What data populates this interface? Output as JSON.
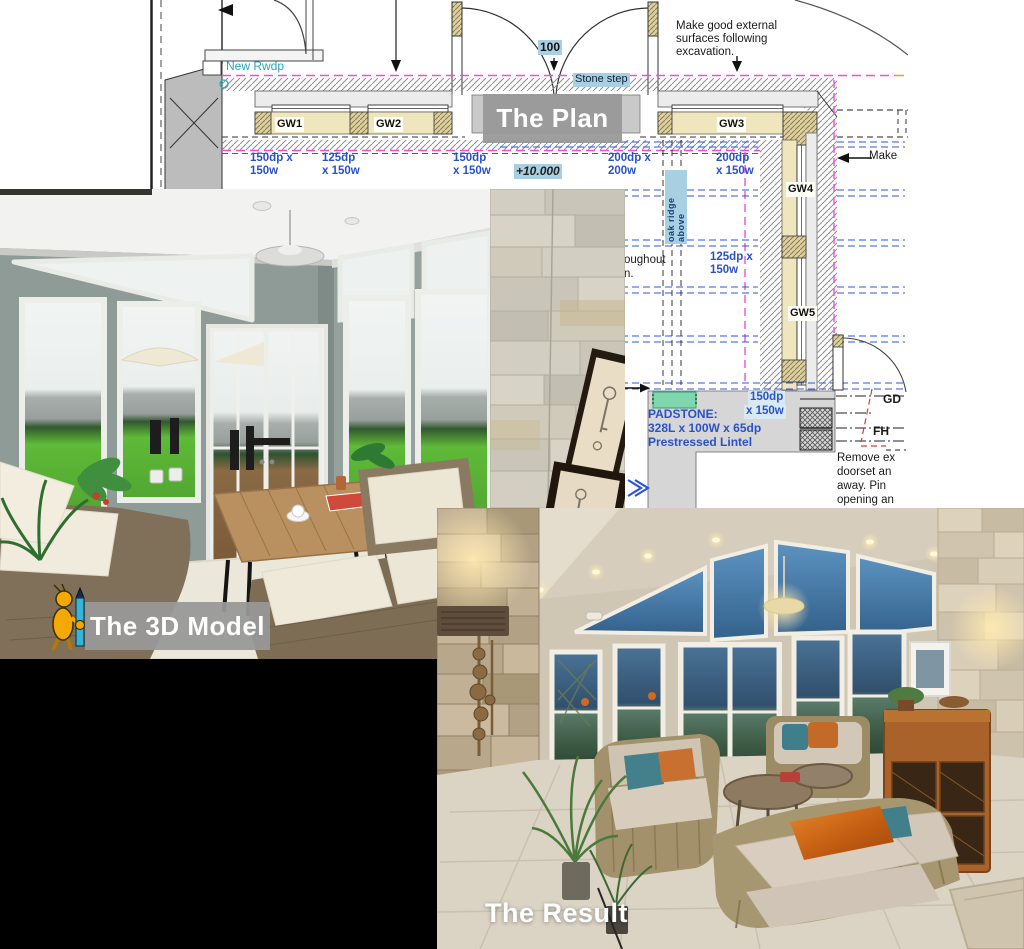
{
  "labels": {
    "plan": "The Plan",
    "model": "The 3D Model",
    "result": "The Result"
  },
  "plan": {
    "annotations": {
      "new_rwdp": "New Rwdp",
      "make_good": "Make good external\nsurfaces following\nexcavation.",
      "step_dim": "100",
      "stone_step": "Stone step",
      "level": "+10.000",
      "oak_ridge": "oak ridge above",
      "partial_line1": "oughout",
      "partial_line2": "n.",
      "make_partial": "Make",
      "padstone_1": "PADSTONE:",
      "padstone_2": "328L x 100W x 65dp",
      "padstone_3": "Prestressed Lintel",
      "gd": "GD",
      "fh": "FH",
      "remove_note": "Remove ex\ndoorset an\naway. Pin\nopening an"
    },
    "gw_labels": [
      "GW1",
      "GW2",
      "GW3",
      "GW4",
      "GW5"
    ],
    "dimensions": [
      "150dp x\n150w",
      "125dp\nx 150w",
      "150dp\nx 150w",
      "200dp x\n200w",
      "200dp\nx 150w",
      "125dp x\n150w",
      "150dp",
      "x 150w"
    ]
  },
  "colors": {
    "dim_blue": "#2a52c8",
    "highlight_blue": "#a9cfe3",
    "magenta_dash": "#ef4fd8",
    "blue_dash": "#2f55e0",
    "padstone_green": "#7fd7ad",
    "caption_gray": "#989898",
    "cyan_note": "#2aa7c0",
    "mascot_yellow": "#f5a800",
    "pencil_cyan": "#35b6d9"
  },
  "icons": {
    "mascot": "figure-with-pencil-mascot"
  }
}
